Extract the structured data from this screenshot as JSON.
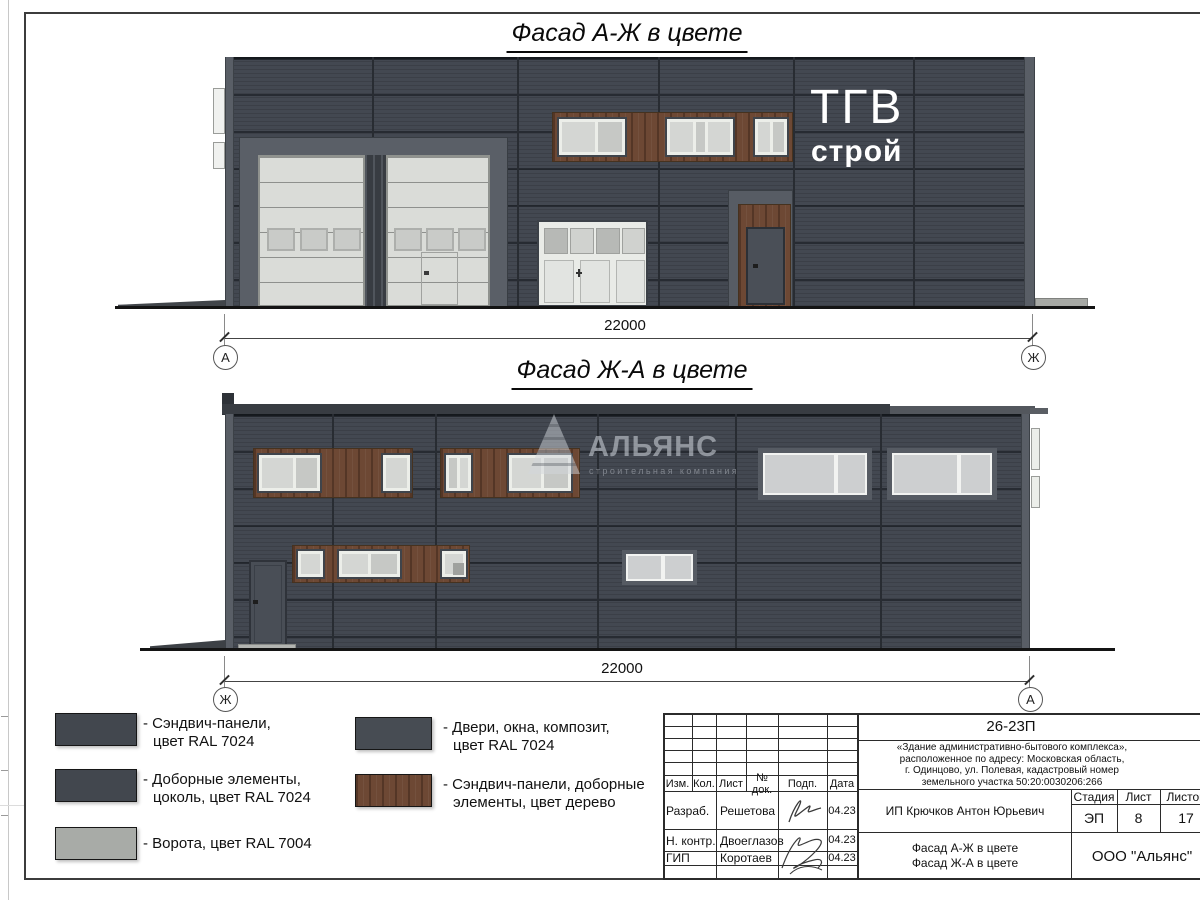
{
  "facade1": {
    "title": "Фасад А-Ж в цвете",
    "dimension": "22000",
    "axis_left": "А",
    "axis_right": "Ж",
    "logo": {
      "line1": "ТГВ",
      "line2": "строй"
    }
  },
  "facade2": {
    "title": "Фасад Ж-А в цвете",
    "dimension": "22000",
    "axis_left": "Ж",
    "axis_right": "А"
  },
  "watermark": {
    "company": "АЛЬЯНС",
    "tagline": "строительная компания"
  },
  "legend": {
    "items": [
      {
        "color": "#42474e",
        "line1": "- Сэндвич-панели,",
        "line2": "цвет RAL 7024"
      },
      {
        "color": "#42474e",
        "line1": "- Доборные элементы,",
        "line2": "цоколь, цвет RAL 7024"
      },
      {
        "color": "#a8aba7",
        "line1": "- Ворота, цвет RAL 7004",
        "line2": ""
      },
      {
        "color": "#474c53",
        "line1": "- Двери, окна, композит,",
        "line2": "цвет RAL 7024"
      },
      {
        "color": "#6d4834",
        "line1": "- Сэндвич-панели, доборные",
        "line2": "элементы, цвет дерево"
      }
    ]
  },
  "titleblock": {
    "code": "26-23П",
    "description": [
      "«Здание административно-бытового комплекса»,",
      "расположенное по адресу: Московская область,",
      "г. Одинцово, ул. Полевая, кадастровый номер",
      "земельного участка 50:20:0030206:266"
    ],
    "columns": [
      "Изм.",
      "Кол.",
      "Лист",
      "№ док.",
      "Подп.",
      "Дата"
    ],
    "rows": [
      {
        "role": "Разраб.",
        "name": "Решетова",
        "date": "04.23"
      },
      {
        "role": "Н. контр.",
        "name": "Двоеглазов",
        "date": "04.23"
      },
      {
        "role": "ГИП",
        "name": "Коротаев",
        "date": "04.23"
      }
    ],
    "client": "ИП Крючков Антон Юрьевич",
    "stage_label": "Стадия",
    "sheet_label": "Лист",
    "sheets_label": "Листов",
    "stage": "ЭП",
    "sheet_no": "8",
    "sheets_total": "17",
    "doc_title": [
      "Фасад А-Ж в цвете",
      "Фасад Ж-А в цвете"
    ],
    "company": "ООО \"Альянс\""
  },
  "colors": {
    "panel_ral7024": "#42474e",
    "gate_ral7004": "#a8aba7",
    "wood": "#6d4834",
    "glass": "#d4d6d3"
  }
}
